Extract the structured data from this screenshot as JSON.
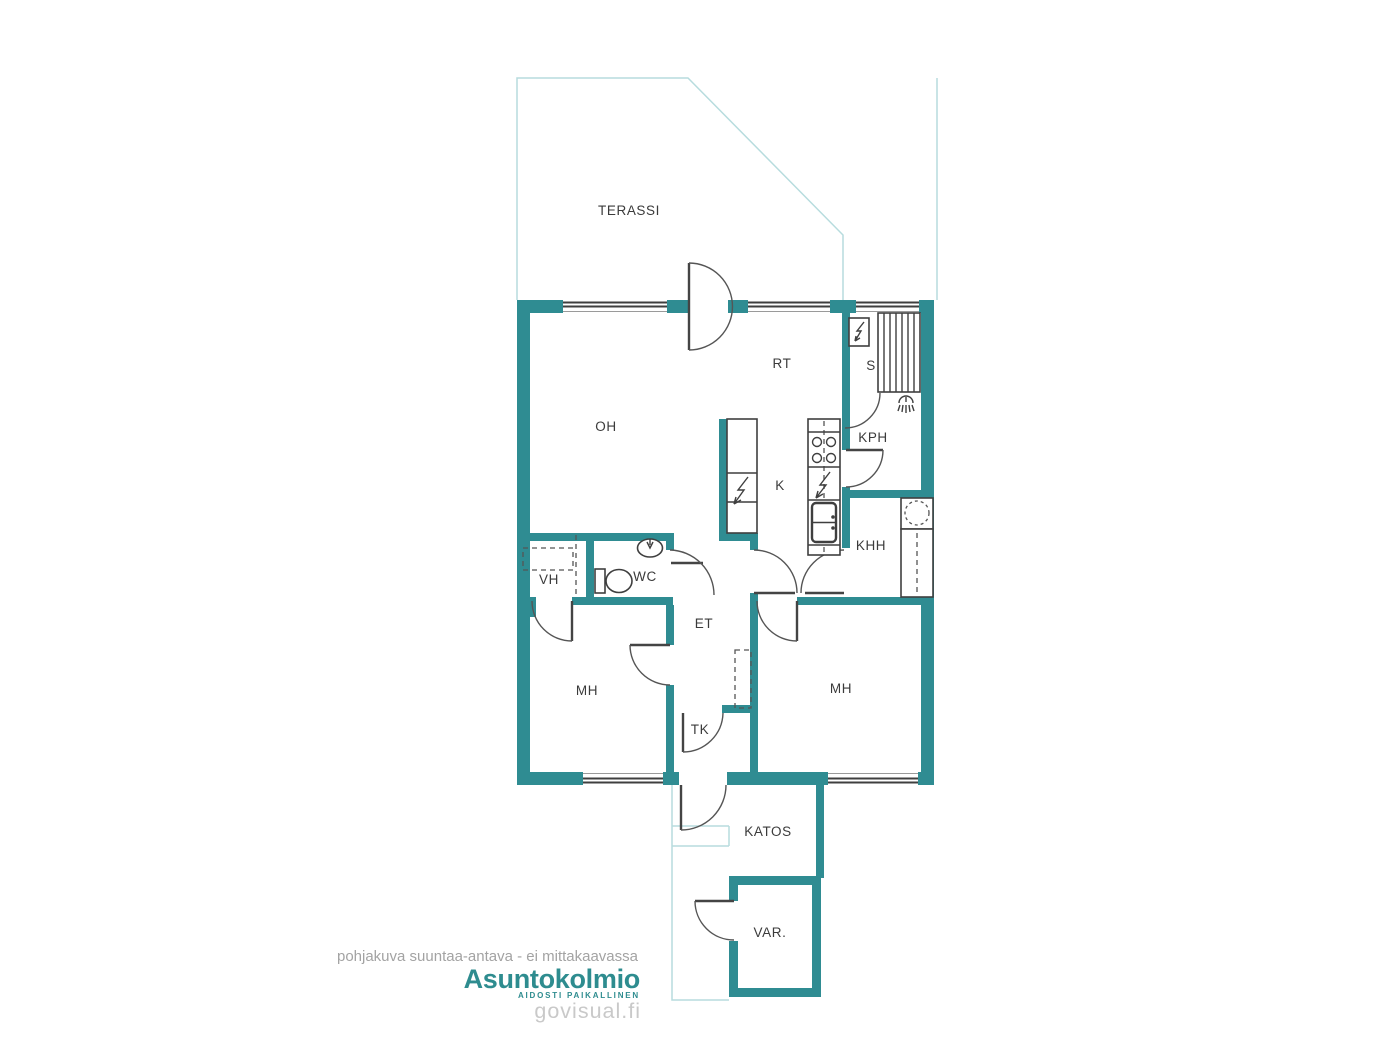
{
  "colors": {
    "wall": "#2f8c92",
    "light_line": "#b7dcde",
    "line": "#3f3f3f",
    "swing": "#555555",
    "label": "#3b3b3b",
    "brand": "#2e8c8f",
    "muted": "#a3a3a3",
    "watermark": "#c9c9c9"
  },
  "rooms": {
    "terassi": "TERASSI",
    "rt": "RT",
    "s": "S",
    "oh": "OH",
    "kph": "KPH",
    "k": "K",
    "khh": "KHH",
    "vh": "VH",
    "wc": "WC",
    "et": "ET",
    "mh_left": "MH",
    "mh_right": "MH",
    "tk": "TK",
    "katos": "KATOS",
    "var": "VAR."
  },
  "footer": {
    "disclaimer": "pohjakuva suuntaa-antava - ei mittakaavassa",
    "brand": "Asuntokolmio",
    "tagline": "AIDOSTI PAIKALLINEN",
    "watermark": "govisual.fi"
  }
}
